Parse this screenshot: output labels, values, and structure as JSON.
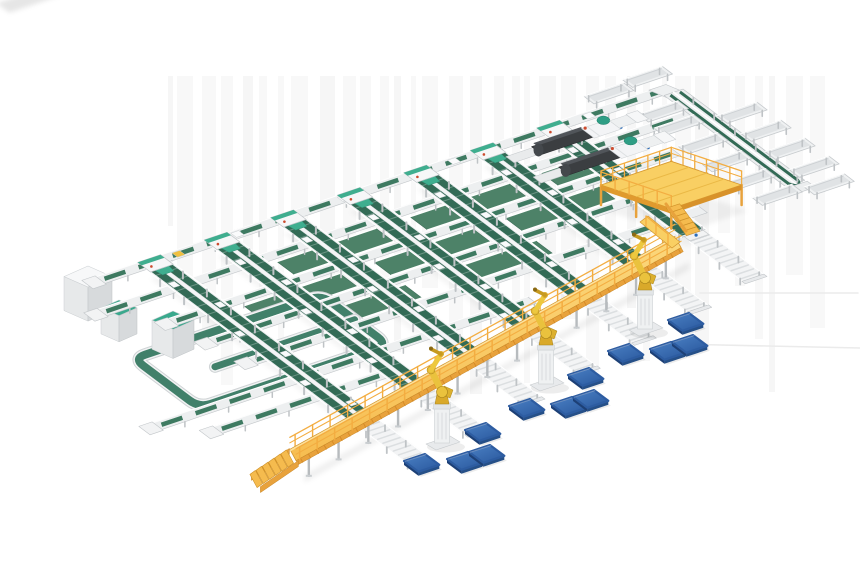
{
  "scene": {
    "kind": "isometric-3d-render",
    "subject": "automated-parcel-sortation-system",
    "components": [
      "infeed-main-line",
      "cross-conveyor-rows",
      "inclined-sorter-spines",
      "wide-floor-belts",
      "recirculation-loop",
      "loop-machines",
      "infeed-cube-machine",
      "scanner-machines",
      "right-spur-line",
      "discharge-troughs",
      "operator-mezzanine",
      "elevated-gantry-walkway",
      "palletizing-robots",
      "blue-pallets",
      "under-gantry-roller-beds"
    ],
    "counts": {
      "spines": 7,
      "robots": 3,
      "pallets": 12,
      "scanner_machines": 2,
      "troughs": 13
    }
  },
  "grid": {
    "origin": [
      95,
      282
    ],
    "u": [
      0.95,
      -0.32
    ],
    "v": [
      0.8,
      0.6
    ]
  },
  "streaks": {
    "x0": 168,
    "x1": 812,
    "y0": 76,
    "hmin": 150,
    "hvar": 170
  },
  "rows": [
    {
      "b": 0,
      "a0": 0,
      "a1": 600
    },
    {
      "b": 38,
      "a0": -30,
      "a1": 596
    },
    {
      "b": 76,
      "a0": 12,
      "a1": 548
    },
    {
      "b": 114,
      "a0": 22,
      "a1": 530
    },
    {
      "b": 152,
      "a0": 32,
      "a1": 512
    },
    {
      "b": 190,
      "a0": -100,
      "a1": 300
    },
    {
      "b": 218,
      "a0": -60,
      "a1": 140
    }
  ],
  "spines": {
    "as": [
      62,
      132,
      202,
      272,
      342,
      412,
      482
    ],
    "bTop": 6,
    "bBot": [
      259,
      245,
      231,
      217,
      204,
      190,
      176
    ]
  },
  "wide_belts": [
    {
      "a0": 152,
      "a1": 256,
      "b": 58
    },
    {
      "a0": 292,
      "a1": 396,
      "b": 58
    },
    {
      "a0": 430,
      "a1": 472,
      "b": 58
    },
    {
      "a0": 85,
      "a1": 186,
      "b": 96
    },
    {
      "a0": 222,
      "a1": 326,
      "b": 96
    },
    {
      "a0": 360,
      "a1": 458,
      "b": 96
    },
    {
      "a0": 120,
      "a1": 222,
      "b": 134
    },
    {
      "a0": 260,
      "a1": 360,
      "b": 134
    }
  ],
  "loop": {
    "a0": -46,
    "a1": 152,
    "b0": 103,
    "b1": 185,
    "inner_b": 144,
    "inner_a0": 5
  },
  "loop_boxes": [
    {
      "x": 101,
      "y": 300,
      "w": 36,
      "h": 26
    },
    {
      "x": 152,
      "y": 311,
      "w": 42,
      "h": 29
    }
  ],
  "white_cube": {
    "x": 64,
    "y": 266,
    "w": 48,
    "h": 34
  },
  "machines": [
    {
      "a": 448,
      "b": 20
    },
    {
      "a": 448,
      "b": 54
    }
  ],
  "right_line": {
    "a": 604,
    "b0": 6,
    "b1": 158
  },
  "troughs": [
    [
      576,
      46
    ],
    [
      576,
      76
    ],
    [
      576,
      106
    ],
    [
      576,
      136
    ],
    [
      634,
      56
    ],
    [
      634,
      86
    ],
    [
      634,
      116
    ],
    [
      634,
      146
    ],
    [
      580,
      164
    ],
    [
      628,
      172
    ],
    [
      578,
      24
    ],
    [
      556,
      -18
    ],
    [
      600,
      -22
    ]
  ],
  "gantry": {
    "from": [
      293,
      455
    ],
    "to": [
      678,
      242
    ],
    "half_width": 6.5
  },
  "mezzanine": {
    "left": [
      601,
      185
    ],
    "ulen": 74,
    "wlen": 74,
    "leg_h": 20
  },
  "robots": [
    [
      442,
      441
    ],
    [
      546,
      382
    ],
    [
      645,
      327
    ]
  ],
  "pallets": [
    [
      404,
      461
    ],
    [
      447,
      459
    ],
    [
      469,
      452
    ],
    [
      465,
      430
    ],
    [
      509,
      406
    ],
    [
      551,
      404
    ],
    [
      573,
      397
    ],
    [
      568,
      375
    ],
    [
      608,
      351
    ],
    [
      650,
      349
    ],
    [
      672,
      342
    ],
    [
      668,
      320
    ]
  ],
  "parcels_on_infeed": [
    {
      "a": 88,
      "color": "#f0c040"
    },
    {
      "a": 150
    },
    {
      "a": 262
    },
    {
      "a": 378
    },
    {
      "a": 520
    }
  ],
  "faint_lines": [
    {
      "x1": 700,
      "y1": 293,
      "x2": 858,
      "y2": 293
    },
    {
      "x1": 676,
      "y1": 344,
      "x2": 860,
      "y2": 348
    }
  ],
  "colors": {
    "background": "#ffffff",
    "streak": "#f2f2f2",
    "frame": "#edeff0",
    "frame_edge": "#c3c7ca",
    "rail_white": "#ffffff",
    "belt": "#3e7a61",
    "belt_dark": "#336b56",
    "belt_wide": "#4d8268",
    "belt_wide_edge": "#3c6e58",
    "teal": "#3fae8f",
    "teal_edge": "#2e8f73",
    "loop_green": "#41806a",
    "gantry_top": "#fbd168",
    "gantry_face": "#e8a23c",
    "gantry_deep": "#d0952e",
    "gantry_hi": "#ffe9ad",
    "rail_yellow": "#f3ad41",
    "stair_tread": "#f5bb4e",
    "mezz_floor": "#f9cf63",
    "mezz_edge": "#d89a2f",
    "robot": "#eac23d",
    "robot_mid": "#d9a92a",
    "robot_dark": "#c79a1f",
    "robot_stroke": "#a8831c",
    "pallet_top1": "#4a80c4",
    "pallet_top2": "#2d5ca1",
    "pallet_side_l": "#1d4076",
    "pallet_side_r": "#265088",
    "machine_dark": "#3b3e41",
    "machine_top": "#51555a",
    "machine_white": "#f3f4f6",
    "cube_top": "#f7f8f9",
    "cube_front": "#e7e9ea",
    "cube_side": "#d7dadc",
    "box_top_teal": "#3aa98d",
    "dot_red": "#cc4b2e",
    "dot_blue": "#2b6cb8",
    "gray_leg": "#bfc3c6",
    "slat": "#dcdfe1",
    "shadow": "#000000"
  }
}
